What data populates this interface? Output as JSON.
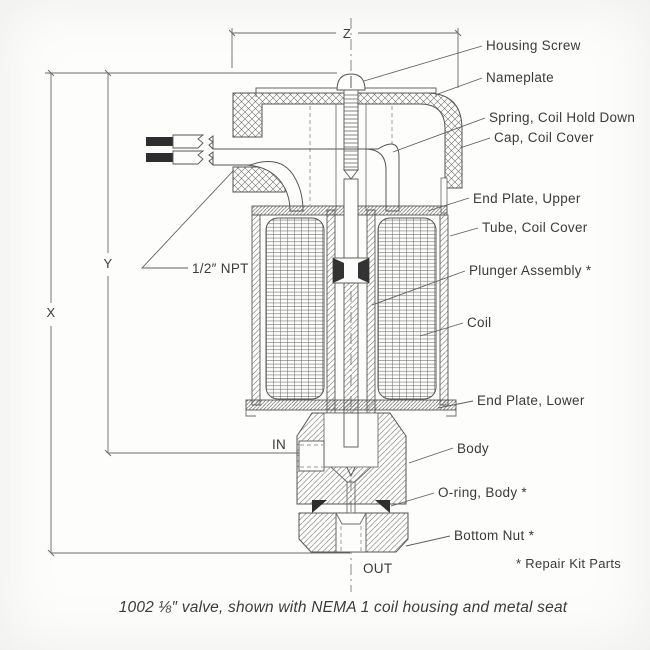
{
  "figure": {
    "caption": "1002 ⅛″ valve, shown with NEMA 1 coil housing and metal seat",
    "footnote": "* Repair Kit Parts",
    "dimensions": {
      "x": "X",
      "y": "Y",
      "z": "Z"
    },
    "ports": {
      "inlet": "IN",
      "outlet": "OUT"
    },
    "conduit_label": "1/2″ NPT",
    "parts": {
      "housing_screw": "Housing Screw",
      "nameplate": "Nameplate",
      "spring_coil_hold_down": "Spring, Coil Hold Down",
      "cap_coil_cover": "Cap, Coil Cover",
      "end_plate_upper": "End Plate, Upper",
      "tube_coil_cover": "Tube, Coil Cover",
      "plunger_assembly": "Plunger Assembly *",
      "coil": "Coil",
      "end_plate_lower": "End Plate, Lower",
      "body": "Body",
      "o_ring_body": "O-ring, Body *",
      "bottom_nut": "Bottom Nut *"
    },
    "colors": {
      "line": "#5a5a5a",
      "text": "#3a3a3a",
      "paper": "#fdfdfc",
      "dark_fill": "#2e2e2e"
    }
  }
}
